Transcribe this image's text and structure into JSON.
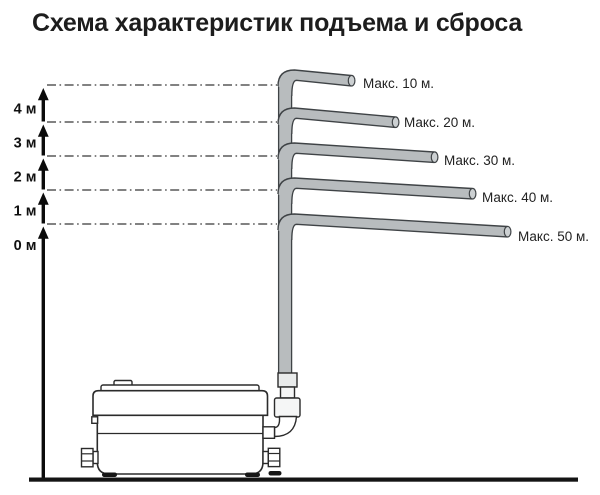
{
  "title": "Схема характеристик подъема и сброса",
  "diagram": {
    "type": "pump-lift-discharge-diagram",
    "axis_marks": [
      "4 м",
      "3 м",
      "2 м",
      "1 м",
      "0 м"
    ],
    "branches": [
      {
        "lift_m": 4,
        "label": "Макс. 10 м.",
        "discharge_m": 10
      },
      {
        "lift_m": 3,
        "label": "Макс. 20 м.",
        "discharge_m": 20
      },
      {
        "lift_m": 2,
        "label": "Макс. 30 м.",
        "discharge_m": 30
      },
      {
        "lift_m": 1,
        "label": "Макс. 40 м.",
        "discharge_m": 40
      },
      {
        "lift_m": 0,
        "label": "Макс. 50 м.",
        "discharge_m": 50
      }
    ],
    "colors": {
      "pipe_fill": "#b8bcbe",
      "pipe_outline": "#3f4346",
      "cap_fill": "#ccd0d2",
      "ink": "#1d1d1d",
      "ground": "#141414"
    }
  }
}
